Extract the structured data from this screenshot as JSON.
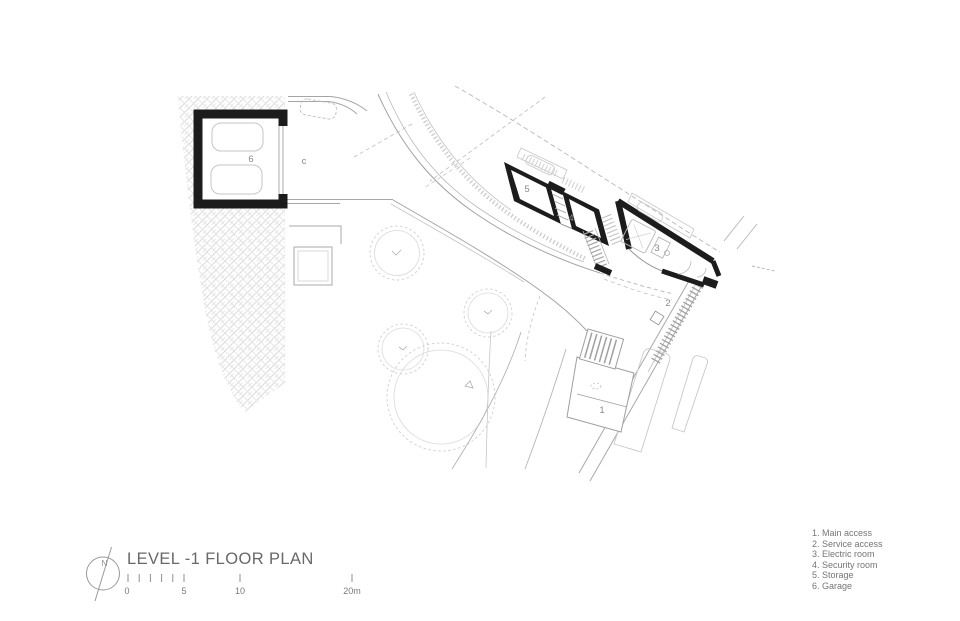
{
  "title_block": {
    "title": "LEVEL -1 FLOOR PLAN",
    "north_label": "N"
  },
  "scale_bar": {
    "labels": [
      "0",
      "5",
      "10",
      "20m"
    ]
  },
  "legend": {
    "items": [
      "1. Main access",
      "2. Service access",
      "3. Electric room",
      "4. Security room",
      "5. Storage",
      "6. Garage"
    ]
  },
  "plan_labels": {
    "main_access": "1",
    "service_access": "2",
    "electric_room": "3",
    "security_room": "4",
    "storage": "5",
    "garage": "6",
    "driveway": "c"
  },
  "colors": {
    "wall": "#1c1c1c",
    "line": "#9a9a9a",
    "light_line": "#c6c6c6",
    "text": "#757575"
  }
}
